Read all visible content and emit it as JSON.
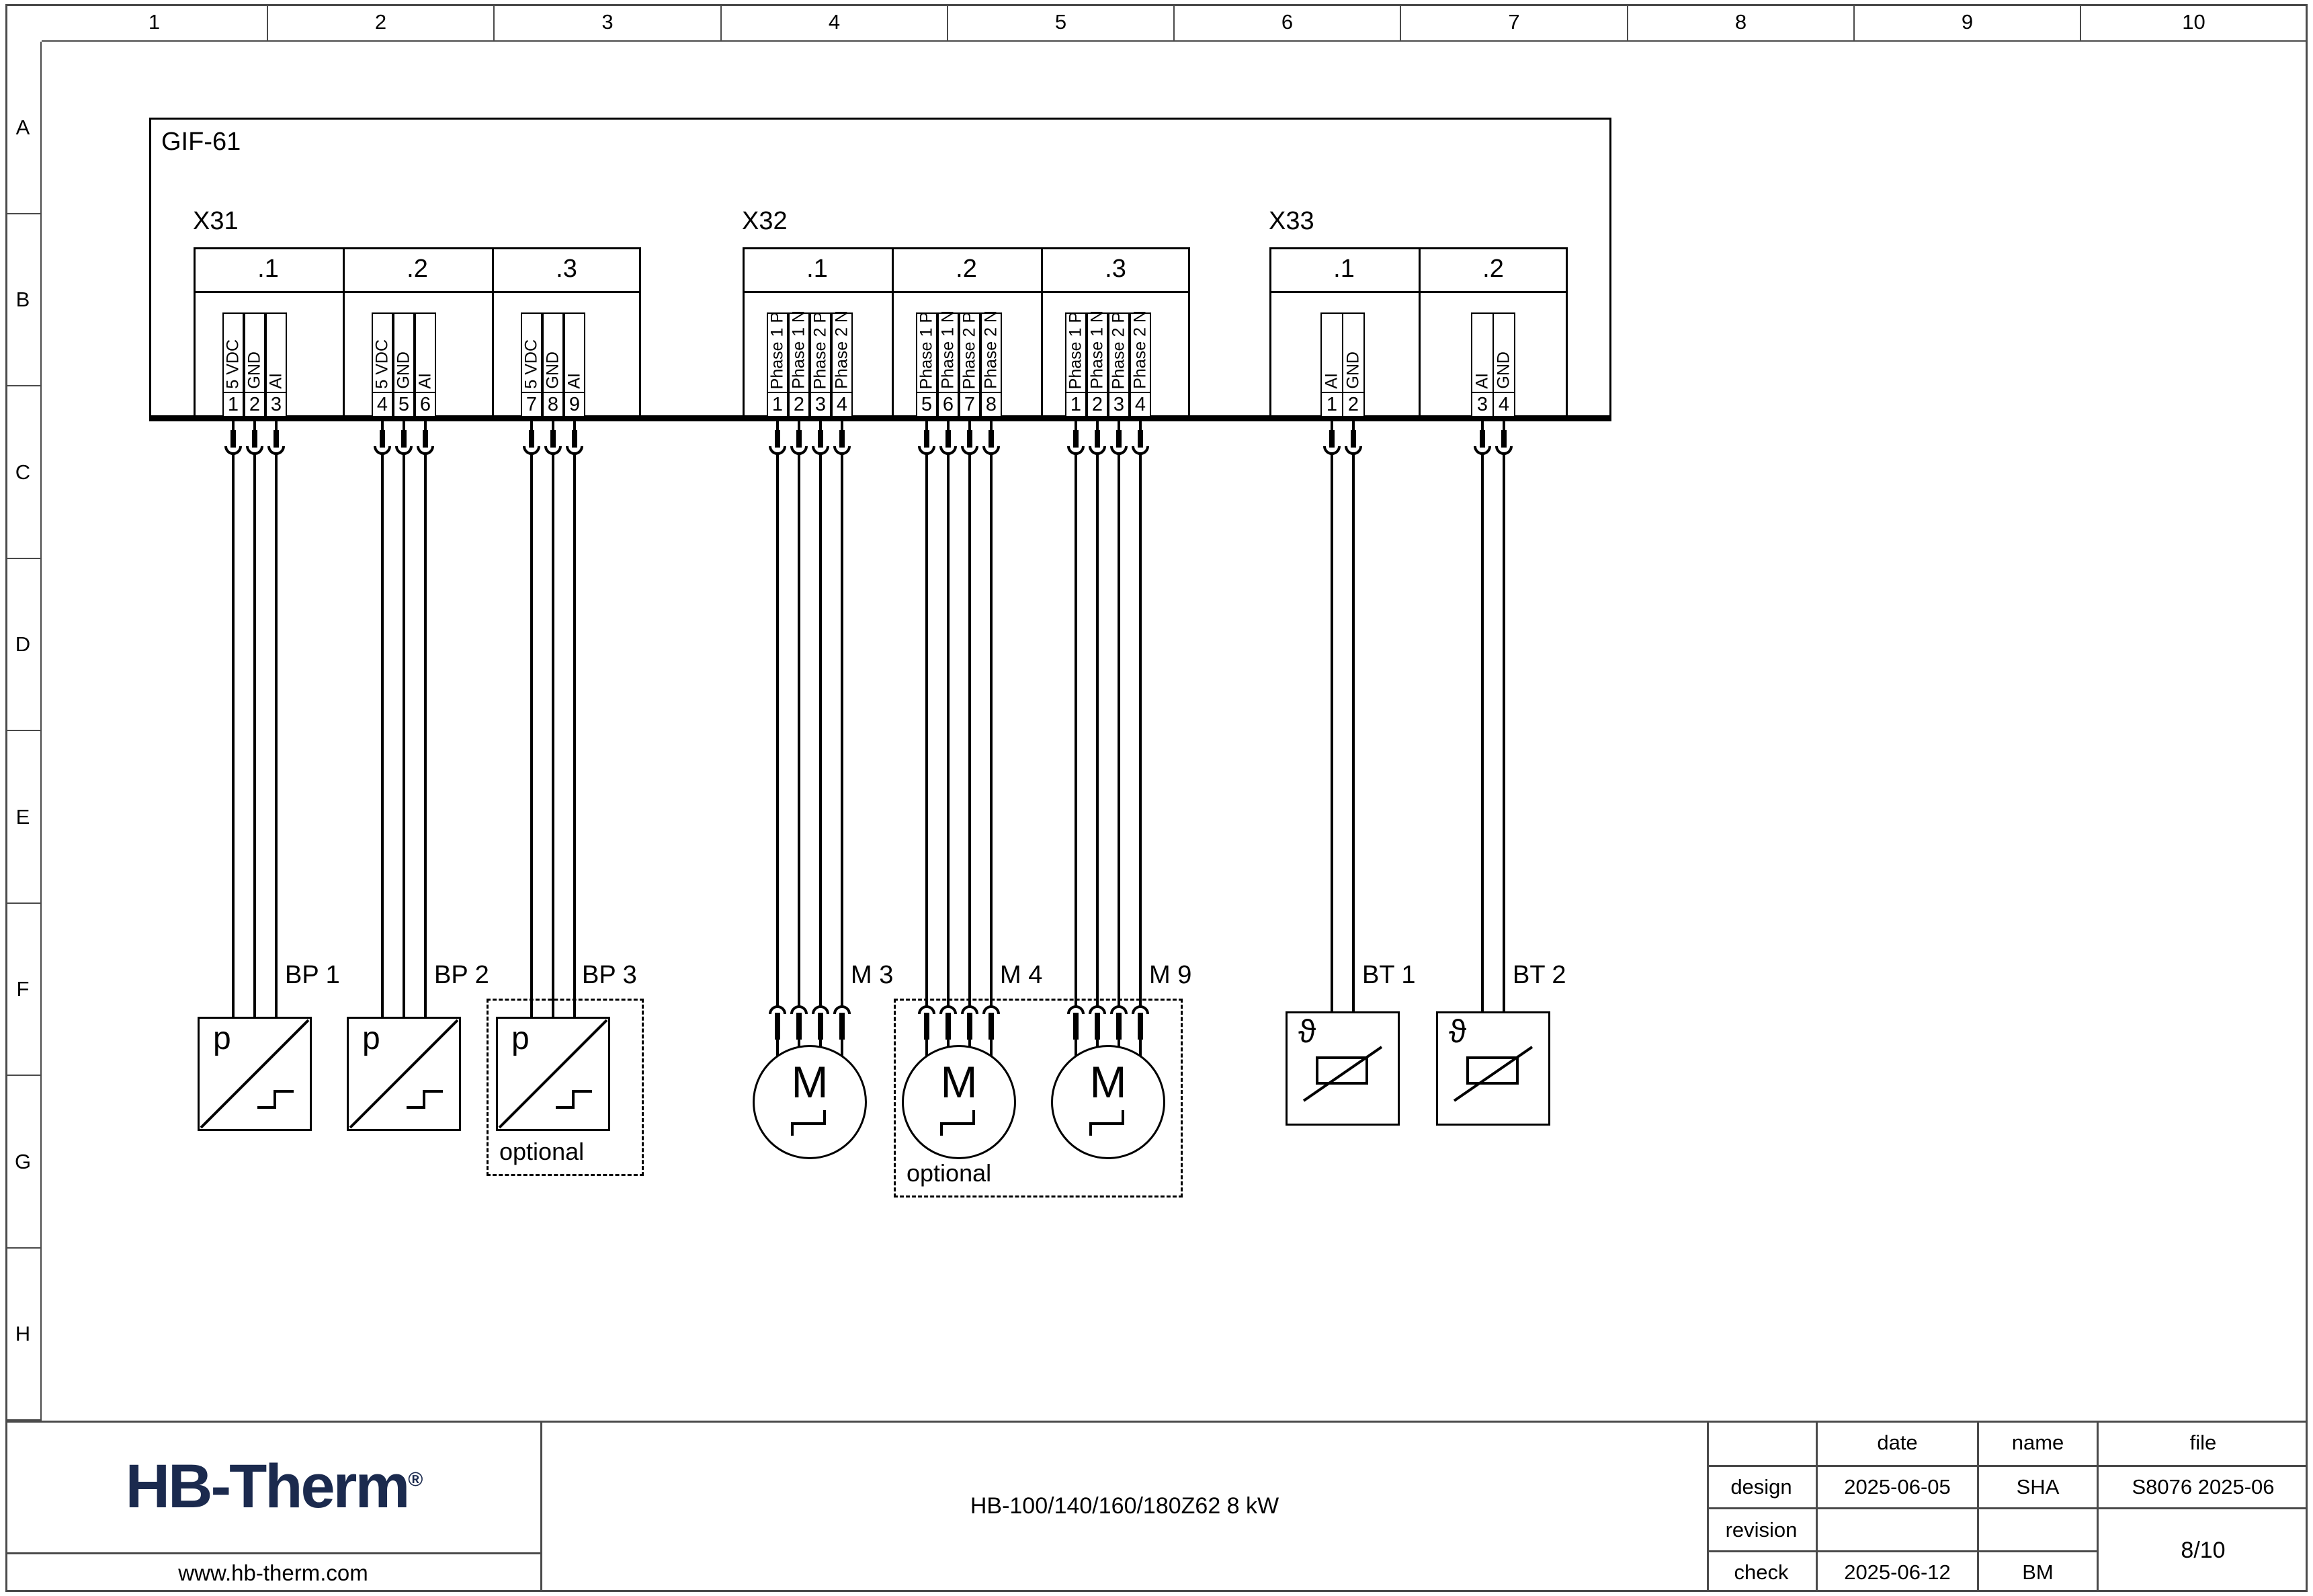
{
  "ruler": {
    "cols": [
      "1",
      "2",
      "3",
      "4",
      "5",
      "6",
      "7",
      "8",
      "9",
      "10"
    ],
    "rows": [
      "A",
      "B",
      "C",
      "D",
      "E",
      "F",
      "G",
      "H"
    ]
  },
  "diagram": {
    "device_label": "GIF-61",
    "optional_label": "optional",
    "connectors": [
      {
        "name": "X31",
        "groups": [
          {
            "label": ".1",
            "pins": [
              {
                "n": "1",
                "signal": "5 VDC"
              },
              {
                "n": "2",
                "signal": "GND"
              },
              {
                "n": "3",
                "signal": "AI"
              }
            ]
          },
          {
            "label": ".2",
            "pins": [
              {
                "n": "4",
                "signal": "5 VDC"
              },
              {
                "n": "5",
                "signal": "GND"
              },
              {
                "n": "6",
                "signal": "AI"
              }
            ]
          },
          {
            "label": ".3",
            "pins": [
              {
                "n": "7",
                "signal": "5 VDC"
              },
              {
                "n": "8",
                "signal": "GND"
              },
              {
                "n": "9",
                "signal": "AI"
              }
            ]
          }
        ]
      },
      {
        "name": "X32",
        "groups": [
          {
            "label": ".1",
            "pins": [
              {
                "n": "1",
                "signal": "Phase 1 P"
              },
              {
                "n": "2",
                "signal": "Phase 1 N"
              },
              {
                "n": "3",
                "signal": "Phase 2 P"
              },
              {
                "n": "4",
                "signal": "Phase 2 N"
              }
            ]
          },
          {
            "label": ".2",
            "pins": [
              {
                "n": "5",
                "signal": "Phase 1 P"
              },
              {
                "n": "6",
                "signal": "Phase 1 N"
              },
              {
                "n": "7",
                "signal": "Phase 2 P"
              },
              {
                "n": "8",
                "signal": "Phase 2 N"
              }
            ]
          },
          {
            "label": ".3",
            "pins": [
              {
                "n": "1",
                "signal": "Phase 1 P"
              },
              {
                "n": "2",
                "signal": "Phase 1 N"
              },
              {
                "n": "3",
                "signal": "Phase 2 P"
              },
              {
                "n": "4",
                "signal": "Phase 2 N"
              }
            ]
          }
        ]
      },
      {
        "name": "X33",
        "groups": [
          {
            "label": ".1",
            "pins": [
              {
                "n": "1",
                "signal": "AI"
              },
              {
                "n": "2",
                "signal": "GND"
              }
            ]
          },
          {
            "label": ".2",
            "pins": [
              {
                "n": "3",
                "signal": "AI"
              },
              {
                "n": "4",
                "signal": "GND"
              }
            ]
          }
        ]
      }
    ],
    "components": [
      {
        "id": "bp1",
        "label": "BP 1",
        "symbol": "p",
        "type": "pressure-sensor"
      },
      {
        "id": "bp2",
        "label": "BP 2",
        "symbol": "p",
        "type": "pressure-sensor"
      },
      {
        "id": "bp3",
        "label": "BP 3",
        "symbol": "p",
        "type": "pressure-sensor",
        "optional": true
      },
      {
        "id": "m3",
        "label": "M 3",
        "symbol": "M",
        "type": "motor"
      },
      {
        "id": "m4",
        "label": "M 4",
        "symbol": "M",
        "type": "motor",
        "optional": true
      },
      {
        "id": "m9",
        "label": "M 9",
        "symbol": "M",
        "type": "motor",
        "optional": true
      },
      {
        "id": "bt1",
        "label": "BT 1",
        "symbol": "ϑ",
        "type": "temperature-sensor"
      },
      {
        "id": "bt2",
        "label": "BT 2",
        "symbol": "ϑ",
        "type": "temperature-sensor"
      }
    ]
  },
  "footer": {
    "logo_text": "HB-Therm",
    "logo_reg": "®",
    "website": "www.hb-therm.com",
    "drawing_title": "HB-100/140/160/180Z62 8 kW",
    "colors": {
      "logo_navy": "#1b2a4e"
    },
    "table": {
      "col_headers": [
        "date",
        "name",
        "file"
      ],
      "design_label": "design",
      "design_date": "2025-06-05",
      "design_name": "SHA",
      "design_file": "S8076 2025-06",
      "revision_label": "revision",
      "revision_date": "",
      "revision_name": "",
      "check_label": "check",
      "check_date": "2025-06-12",
      "check_name": "BM",
      "page": "8/10"
    }
  }
}
